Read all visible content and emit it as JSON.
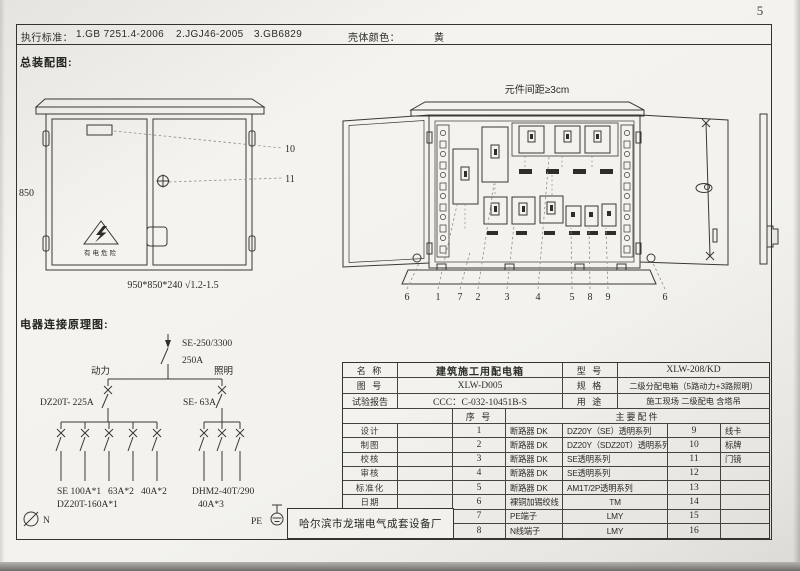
{
  "page": {
    "number": "5"
  },
  "header": {
    "standards_label": "执行标准：",
    "standards": [
      "1.GB 7251.4-2006",
      "2.JGJ46-2005",
      "3.GB6829"
    ],
    "shell_color_label": "壳体颜色：",
    "shell_color_value": "黄"
  },
  "sections": {
    "assembly_title": "总装配图:",
    "schematic_title": "电器连接原理图:"
  },
  "front_view": {
    "height_dim": "850",
    "warning_text": "有电危险",
    "size_note": "950*850*240 √1.2-1.5",
    "callouts": [
      "10",
      "11"
    ]
  },
  "open_view": {
    "spacing_note": "元件间距≥3cm",
    "callouts": [
      "6",
      "1",
      "7",
      "2",
      "3",
      "4",
      "5",
      "8",
      "9",
      "6"
    ]
  },
  "schematic": {
    "main_breaker": "SE-250/3300",
    "main_current": "250A",
    "branch_power": "动力",
    "branch_lighting": "照明",
    "power_breaker": "DZ20T- 225A",
    "lighting_breaker": "SE- 63A",
    "power_sub_1": "SE 100A*1",
    "power_sub_2": "63A*2",
    "power_sub_3": "40A*2",
    "power_sub_note": "DZ20T-160A*1",
    "lighting_sub": "DHM2-40T/290",
    "lighting_sub_note": "40A*3",
    "neutral_label": "N",
    "pe_label": "PE"
  },
  "info_table": {
    "name_label": "名 称",
    "name_value": "建筑施工用配电箱",
    "model_label": "型 号",
    "model_value": "XLW-208/KD",
    "drawing_label": "图 号",
    "drawing_value": "XLW-D005",
    "spec_label": "规 格",
    "spec_value": "二级分配电箱（5路动力+3路照明）",
    "report_label": "试验报告",
    "report_value": "CCC：C-032-10451B-S",
    "usage_label": "用 途",
    "usage_value": "施工现场 二级配电 含塔吊",
    "seq_header": "序 号",
    "parts_header": "主要配件",
    "roles": [
      "设计",
      "制图",
      "校核",
      "审核",
      "标准化",
      "日期"
    ],
    "company": "哈尔滨市龙瑞电气成套设备厂",
    "rows": [
      {
        "no": "1",
        "part": "断路器 DK",
        "series": "DZ20Y（SE）透明系列",
        "no2": "9",
        "part2": "线卡"
      },
      {
        "no": "2",
        "part": "断路器 DK",
        "series": "DZ20Y（SDZ20T）透明系列",
        "no2": "10",
        "part2": "标牌"
      },
      {
        "no": "3",
        "part": "断路器 DK",
        "series": "SE透明系列",
        "no2": "11",
        "part2": "门镜"
      },
      {
        "no": "4",
        "part": "断路器 DK",
        "series": "SE透明系列",
        "no2": "12",
        "part2": ""
      },
      {
        "no": "5",
        "part": "断路器 DK",
        "series": "AM1T/2P透明系列",
        "no2": "13",
        "part2": ""
      },
      {
        "no": "6",
        "part": "裸铜加锡绞线",
        "series": "TM",
        "no2": "14",
        "part2": ""
      },
      {
        "no": "7",
        "part": "PE端子",
        "series": "LMY",
        "no2": "15",
        "part2": ""
      },
      {
        "no": "8",
        "part": "N线端子",
        "series": "LMY",
        "no2": "16",
        "part2": ""
      }
    ]
  }
}
